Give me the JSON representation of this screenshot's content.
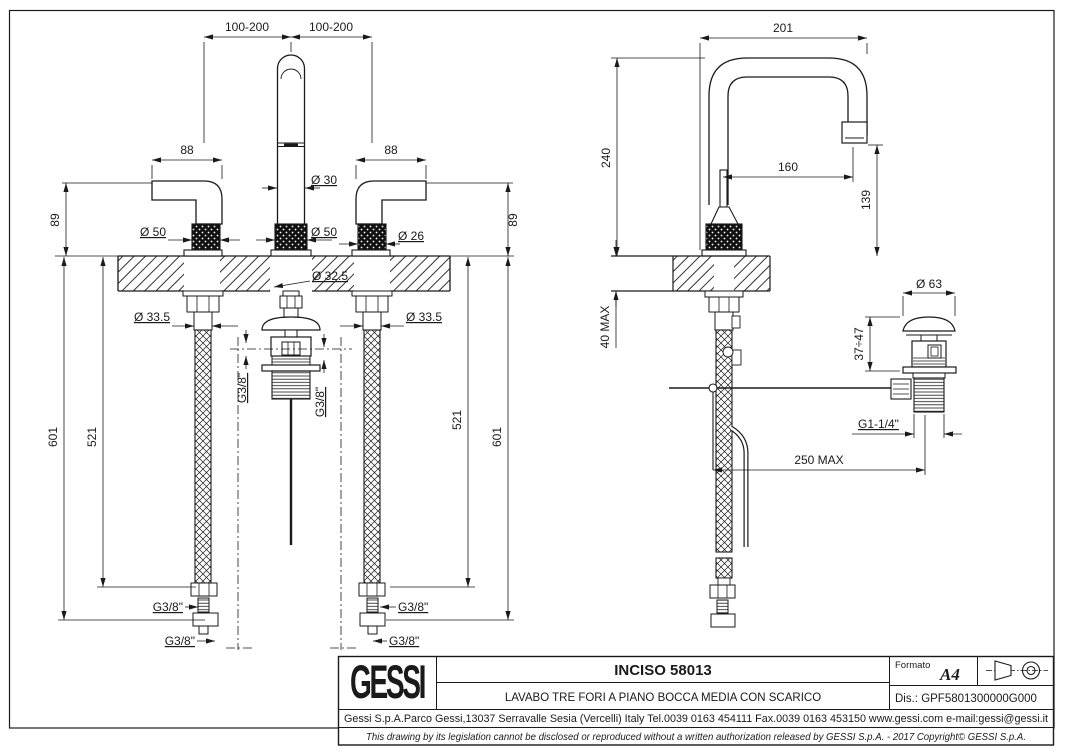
{
  "fv": {
    "spacing_l": "100-200",
    "spacing_r": "100-200",
    "width_l": "88",
    "width_r": "88",
    "d30": "Ø 30",
    "d50_l": "Ø 50",
    "d50_c": "Ø 50",
    "d26": "Ø 26",
    "h89_l": "89",
    "h89_r": "89",
    "d32": "Ø 32.5",
    "d33_l": "Ø 33.5",
    "d33_r": "Ø 33.5",
    "l601_l": "601",
    "l521_l": "521",
    "l521_r": "521",
    "l601_r": "601",
    "g38_a": "G3/8\"",
    "g38_b": "G3/8\"",
    "g38_c": "G3/8\"",
    "g38_d": "G3/8\"",
    "g38_e": "G3/8\"",
    "g38_f": "G3/8\""
  },
  "sv": {
    "r201": "201",
    "h240": "240",
    "r160": "160",
    "h139": "139",
    "t40": "40 MAX",
    "d63": "Ø 63",
    "adj": "37÷47",
    "g114": "G1-1/4\"",
    "m250": "250 MAX"
  },
  "tb": {
    "logo": "GESSI",
    "code": "INCISO 58013",
    "desc": "LAVABO TRE FORI A PIANO BOCCA MEDIA CON SCARICO",
    "formato_label": "Formato",
    "formato_value": "A4",
    "dis": "Dis.: GPF5801300000G000",
    "company": "Gessi S.p.A.Parco Gessi,13037 Serravalle Sesia (Vercelli) Italy Tel.0039 0163 454111 Fax.0039 0163 453150 www.gessi.com e-mail:gessi@gessi.it",
    "copyright": "This drawing by its legislation cannot be disclosed or reproduced without a written authorization released by GESSI S.p.A. - 2017 Copyright© GESSI S.p.A."
  },
  "colors": {
    "ink": "#1a1a1a",
    "paper": "#ffffff"
  }
}
